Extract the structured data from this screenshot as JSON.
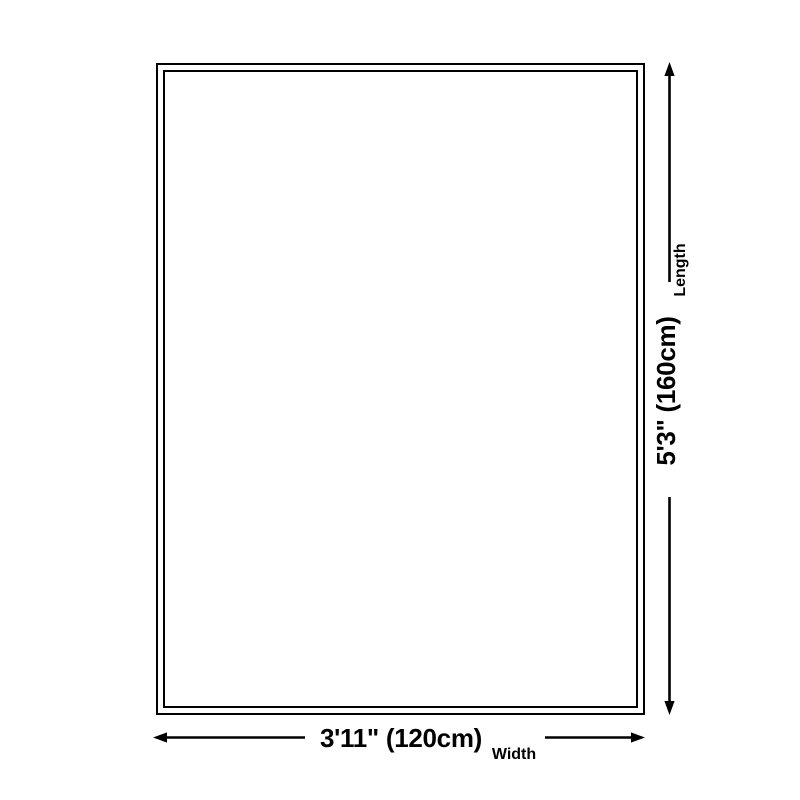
{
  "page": {
    "background_color": "#ffffff",
    "line_color": "#000000",
    "text_color": "#000000"
  },
  "diagram": {
    "rug": {
      "fill": "#ffffff",
      "outline": "double-black-frame"
    },
    "length": {
      "value": "5'3\" (160cm)",
      "label": "Length"
    },
    "width": {
      "value": "3'11\" (120cm)",
      "label": "Width"
    },
    "icons": {
      "up": "arrow-up-icon",
      "down": "arrow-down-icon",
      "left": "arrow-left-icon",
      "right": "arrow-right-icon"
    }
  }
}
